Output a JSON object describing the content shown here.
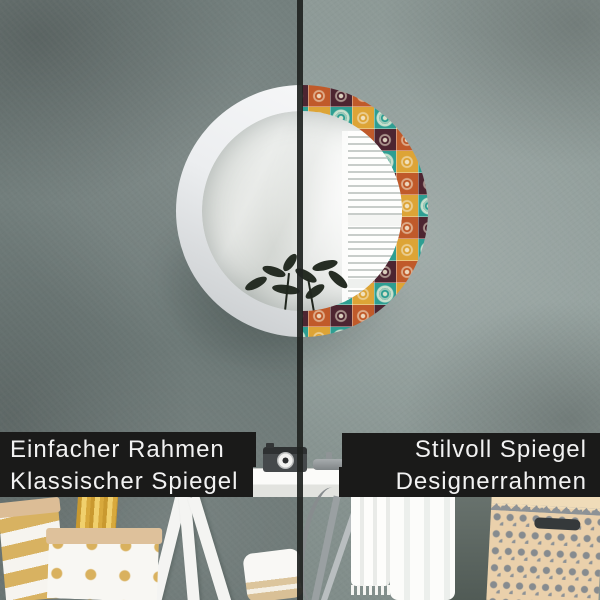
{
  "labels": {
    "left": {
      "line1": "Einfacher Rahmen",
      "line2": "Klassischer Spiegel"
    },
    "right": {
      "line1": "Stilvoll Spiegel",
      "line2": "Designerrahmen"
    }
  },
  "palette": {
    "label_background": "#1a1a19",
    "label_text": "#f2f2f2",
    "wall_left": "#75817f",
    "wall_right": "#8b9794",
    "frame_plain": "#eceef0",
    "tile_maroon": "#4d2531",
    "tile_teal": "#2e9e92",
    "tile_gold": "#dda436",
    "tile_orange": "#c05a2a",
    "basket_tan": "#ead0ab",
    "divider": "#202421"
  }
}
